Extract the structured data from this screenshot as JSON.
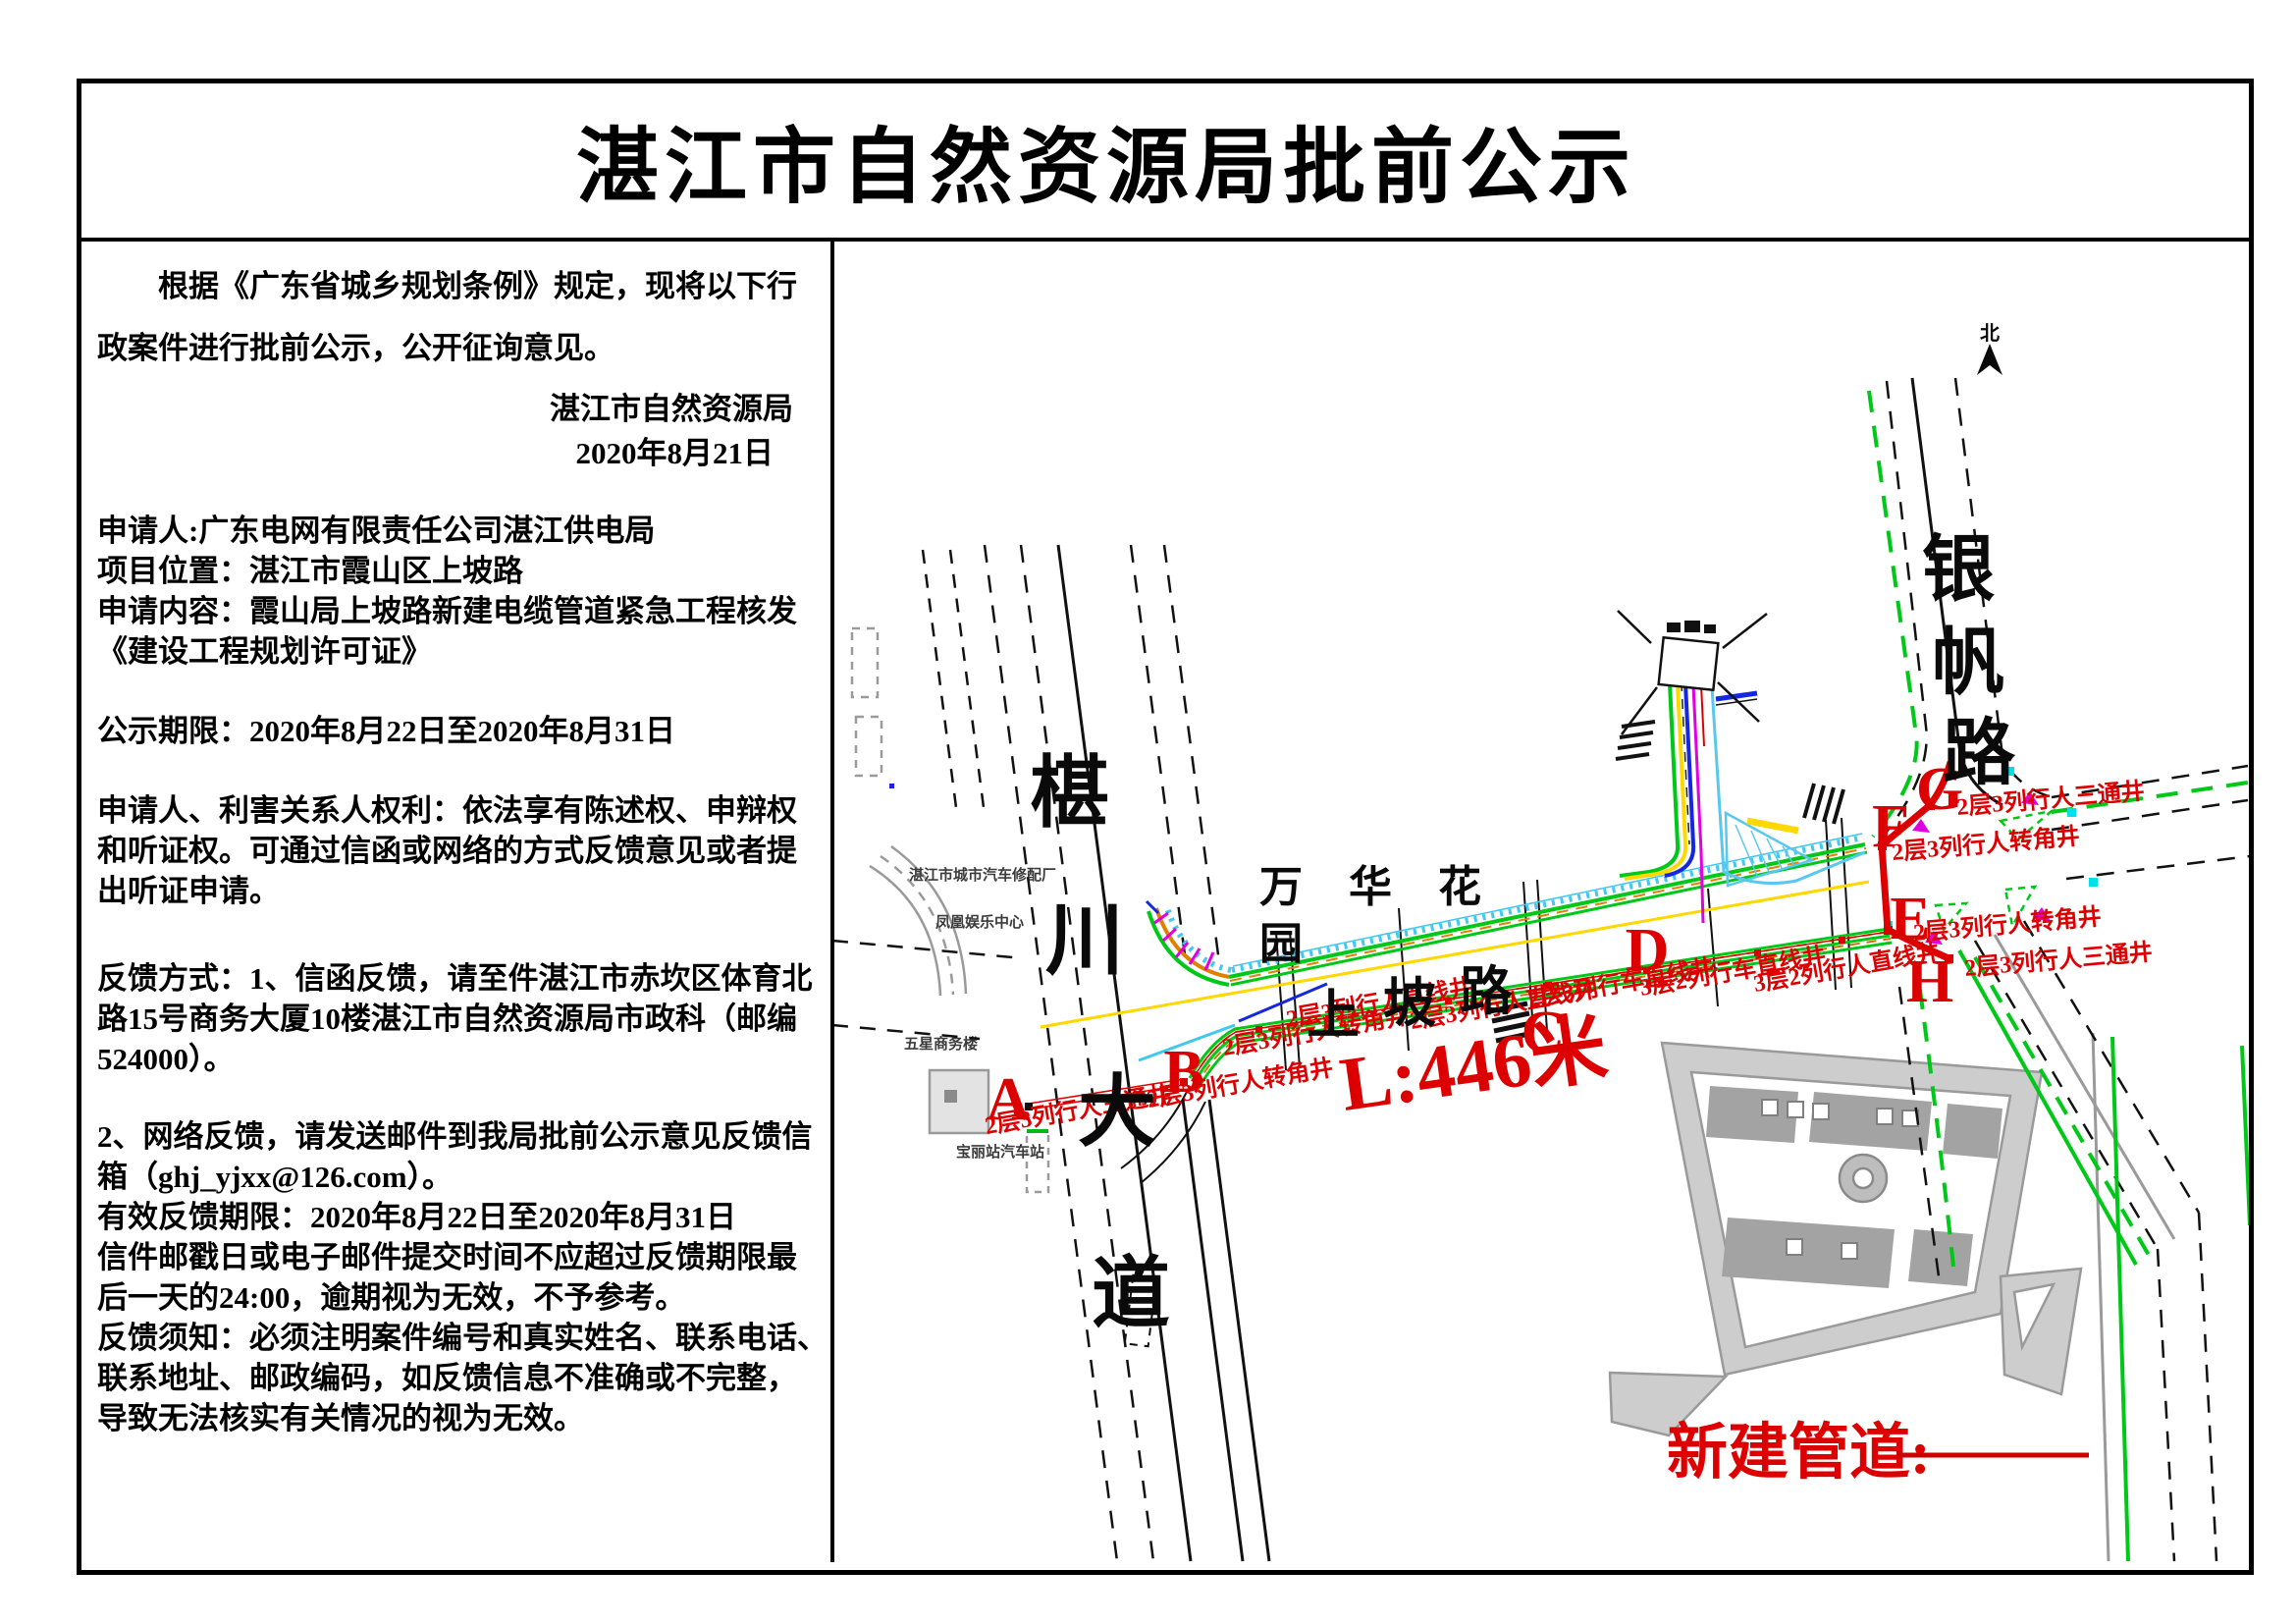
{
  "page": {
    "title": "湛江市自然资源局批前公示"
  },
  "notice": {
    "para1": "　　根据《广东省城乡规划条例》规定，现将以下行",
    "para2": "政案件进行批前公示，公开征询意见。",
    "signer": "湛江市自然资源局",
    "sign_date": "2020年8月21日",
    "applicant": "申请人:广东电网有限责任公司湛江供电局",
    "location": "项目位置：湛江市霞山区上坡路",
    "content1": "申请内容：霞山局上坡路新建电缆管道紧急工程核发",
    "content2": "《建设工程规划许可证》",
    "period": "公示期限：2020年8月22日至2020年8月31日",
    "rights1": "申请人、利害关系人权利：依法享有陈述权、申辩权",
    "rights2": "和听证权。可通过信函或网络的方式反馈意见或者提",
    "rights3": "出听证申请。",
    "fb1": "反馈方式：1、信函反馈，请至件湛江市赤坎区体育北",
    "fb2": "路15号商务大厦10楼湛江市自然资源局市政科（邮编",
    "fb3": "524000）。",
    "net1": "2、网络反馈，请发送邮件到我局批前公示意见反馈信",
    "net2": "箱（ghj_yjxx@126.com）。",
    "valid": "有效反馈期限：2020年8月22日至2020年8月31日",
    "mail1": "信件邮戳日或电子邮件提交时间不应超过反馈期限最",
    "mail2": "后一天的24:00，逾期视为无效，不予参考。",
    "note1": "反馈须知：必须注明案件编号和真实姓名、联系电话、",
    "note2": "联系地址、邮政编码，如反馈信息不准确或不完整，",
    "note3": "导致无法核实有关情况的视为无效。"
  },
  "map": {
    "north_label": "北",
    "length_label": "L:446米",
    "legend_label": "新建管道:",
    "route_letters": [
      "A",
      "B",
      "C",
      "D",
      "E",
      "F",
      "G",
      "H"
    ],
    "wells": [
      {
        "text": "2层3列行人三通井"
      },
      {
        "text": "2层3列行人转角井"
      },
      {
        "text": "2层3列行人转角井"
      },
      {
        "text": "2层3列行人直线井"
      },
      {
        "text": "2层3列行人直线井"
      },
      {
        "text": "2层3列行车直线井"
      },
      {
        "text": "3层2列行车直线井"
      },
      {
        "text": "3层2列行人直线井"
      },
      {
        "text": "2层3列行人三通井"
      },
      {
        "text": "2层3列行人转角井"
      },
      {
        "text": "2层3列行人转角井"
      },
      {
        "text": "2层3列行人三通井"
      }
    ],
    "roads": {
      "chuanchuan": [
        "椹",
        "川",
        "大",
        "道"
      ],
      "shangpo": [
        "上",
        "坡",
        "路"
      ],
      "yinfan": [
        "银",
        "帆",
        "路"
      ],
      "wanhua_line1": "万 华 花",
      "wanhua_line2": "园"
    },
    "poi_labels": [
      "湛江市城市汽车修配厂",
      "凤凰娱乐中心",
      "五星商务楼",
      "宝丽站汽车站"
    ],
    "colors": {
      "route_red": "#dd0000",
      "pipe_green": "#00c818",
      "pipe_yellow": "#ffd800",
      "pipe_blue": "#1428e0",
      "pipe_magenta": "#e000e0",
      "pipe_cyan": "#40c8f0",
      "pipe_orange": "#e08000"
    }
  }
}
